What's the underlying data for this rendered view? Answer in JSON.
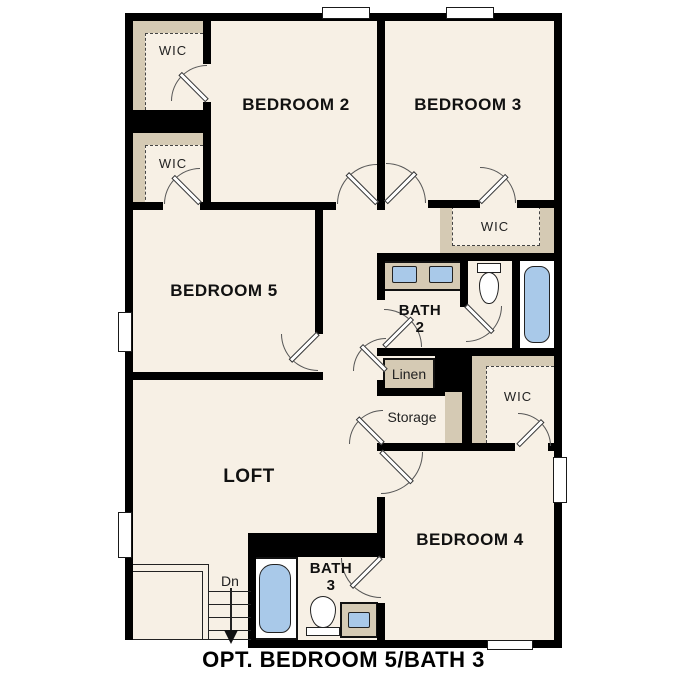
{
  "caption": "OPT. BEDROOM 5/BATH 3",
  "colors": {
    "floor": "#f7f0e5",
    "wall": "#000000",
    "closet": "#d5cab4",
    "fixture": "#a9c9e9"
  },
  "labels": {
    "wic_top1": "WIC",
    "wic_top2": "WIC",
    "bedroom2": "BEDROOM 2",
    "bedroom3": "BEDROOM 3",
    "wic_bed3": "WIC",
    "bedroom5": "BEDROOM 5",
    "bath2_line1": "BATH",
    "bath2_line2": "2",
    "linen": "Linen",
    "storage": "Storage",
    "wic_bed4": "WIC",
    "loft": "LOFT",
    "stairs_dn": "Dn",
    "bath3_line1": "BATH",
    "bath3_line2": "3",
    "bedroom4": "BEDROOM 4"
  }
}
